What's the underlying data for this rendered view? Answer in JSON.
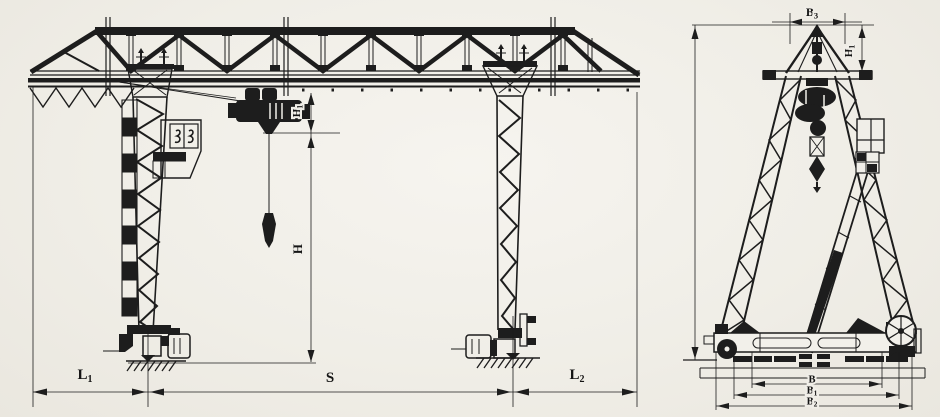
{
  "labels": {
    "front_view": {
      "h1": {
        "base": "H",
        "sub": "1"
      },
      "h": {
        "base": "H",
        "sub": ""
      },
      "l1": {
        "base": "L",
        "sub": "1"
      },
      "span": {
        "base": "S",
        "sub": ""
      },
      "l2": {
        "base": "L",
        "sub": "2"
      }
    },
    "side_view": {
      "b3": {
        "base": "B",
        "sub": "3"
      },
      "h1": {
        "base": "H",
        "sub": "1"
      },
      "b": {
        "base": "B",
        "sub": ""
      },
      "b1": {
        "base": "B",
        "sub": "1"
      },
      "b2": {
        "base": "B",
        "sub": "2"
      }
    }
  }
}
